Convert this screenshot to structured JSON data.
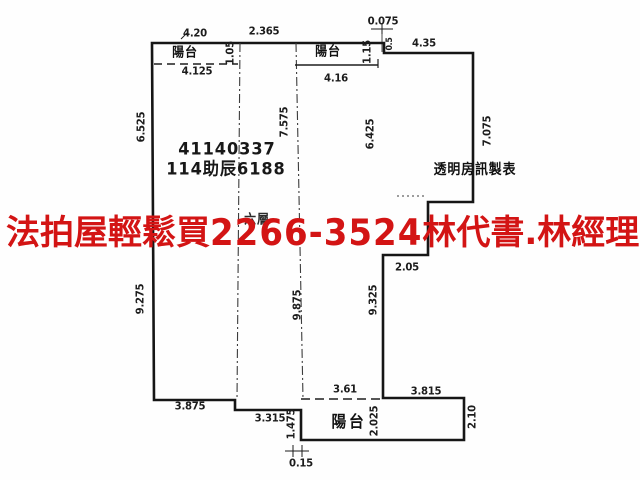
{
  "watermark": {
    "agency": "法拍屋輕鬆買",
    "phone": "2266-3524",
    "agent": "林代書.林經理",
    "color": "#d31414"
  },
  "plan": {
    "case_number": "41140337",
    "case_reference": "114助辰6188",
    "source_label": "透明房訊製表",
    "floor_label": "六層",
    "balcony_label": "陽台"
  },
  "colors": {
    "wall_line": "#161616",
    "dim_text": "#1c1c1c",
    "background": "#fefefe"
  },
  "dimensions": {
    "balcony_tl_width": "4.20",
    "top_mid_width": "2.365",
    "top_offset": "0.075",
    "top_right_width": "4.35",
    "balcony_tl_inner_width": "4.125",
    "balcony_tr_inner_width": "4.16",
    "balcony_tl_depth": "1.05",
    "balcony_tr_depth": "1.15",
    "top_step_height": "0.5",
    "left_upper_height": "6.525",
    "mid_upper_height": "7.575",
    "right_upper_height": "6.425",
    "far_right_height": "7.075",
    "left_lower_height": "9.275",
    "mid_lower_height": "9.875",
    "right_lower_height": "9.325",
    "right_step_width": "2.05",
    "bottom_left_width": "3.875",
    "bottom_mid_width": "3.315",
    "bottom_step_height": "1.475",
    "bottom_offset": "0.15",
    "balcony_b_top_width": "3.61",
    "balcony_b_right_width": "3.815",
    "balcony_b_depth": "2.025",
    "balcony_b_right_depth": "2.10"
  }
}
